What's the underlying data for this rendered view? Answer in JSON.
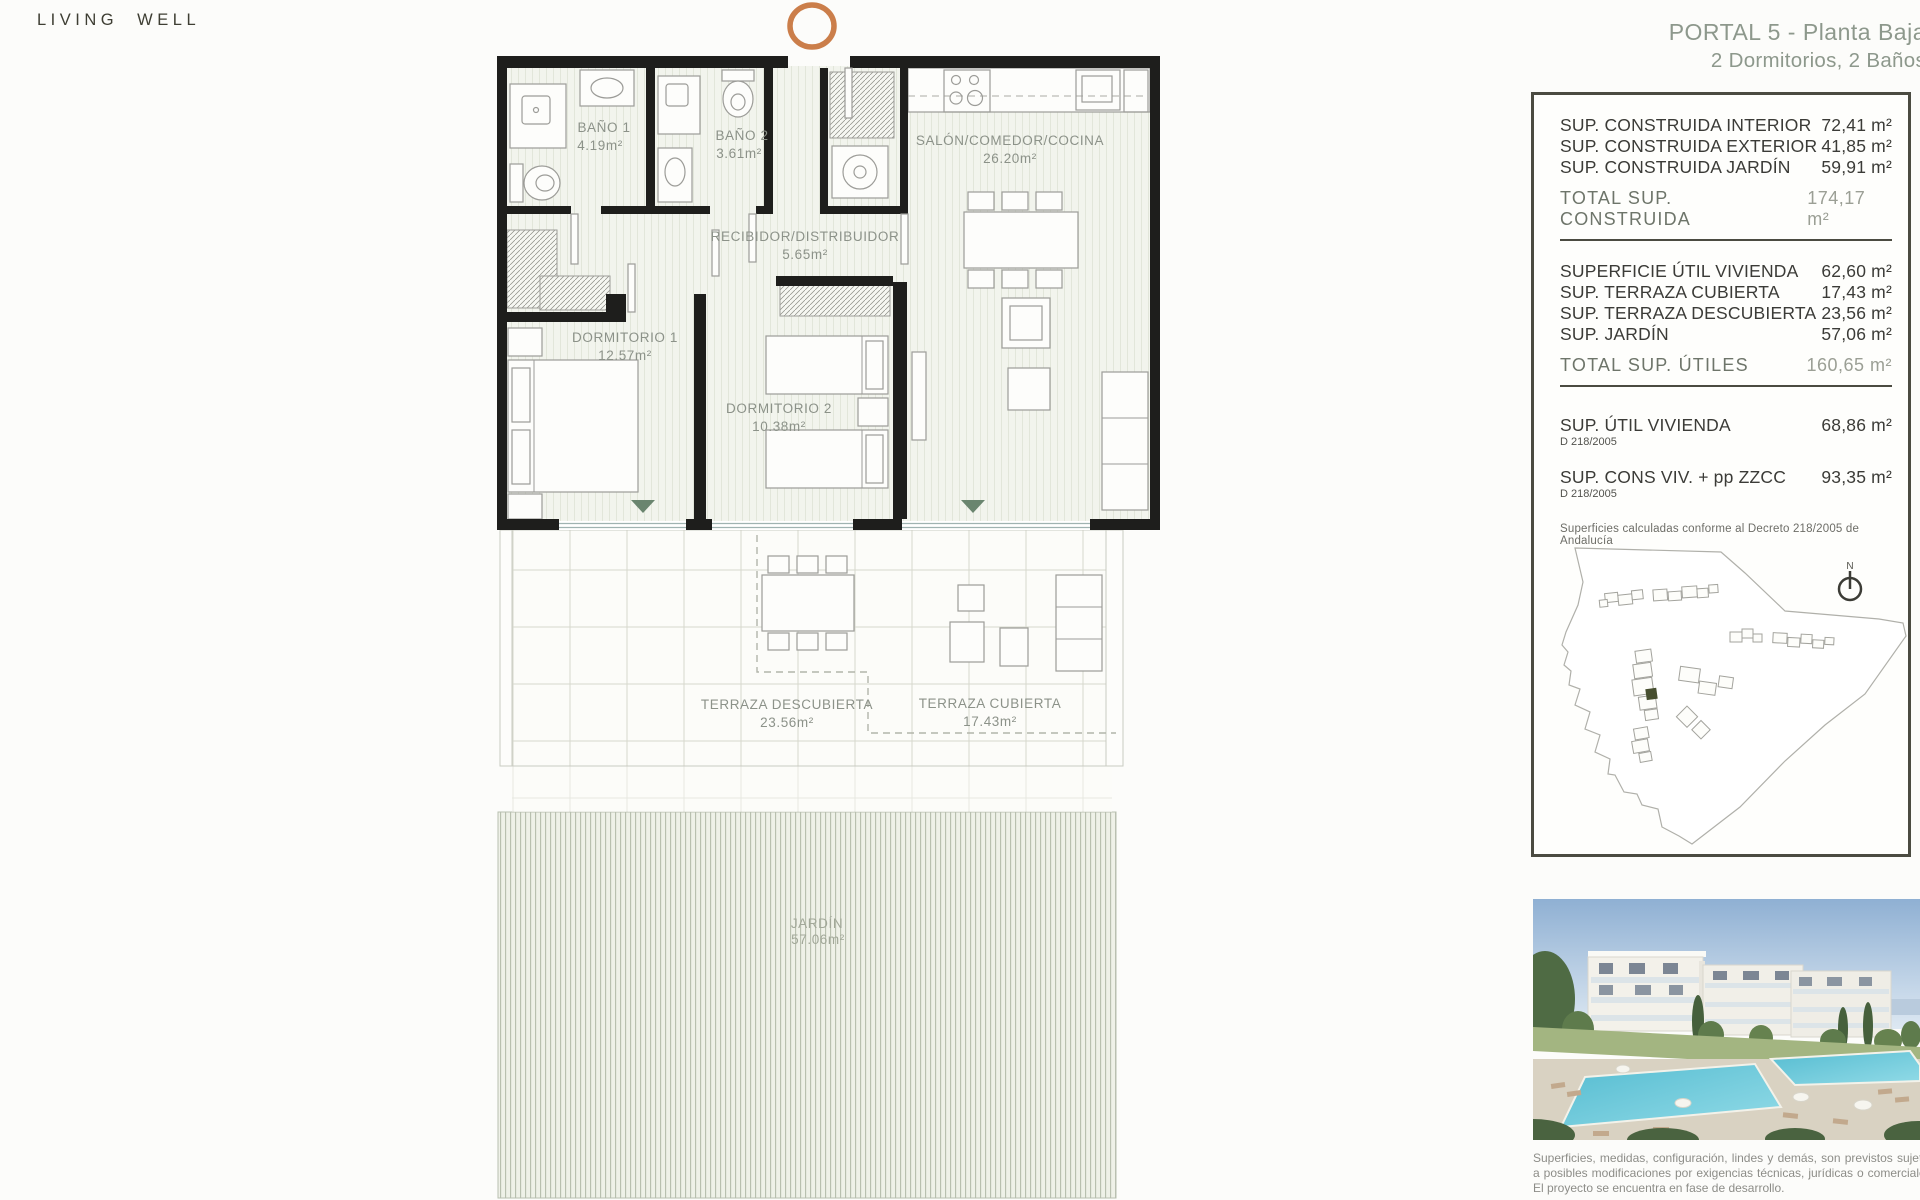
{
  "brand": {
    "logo": "LIVING WELL"
  },
  "header": {
    "title_line1": "PORTAL 5 - Planta Baja",
    "title_line2": "2 Dormitorios, 2 Baños"
  },
  "floorplan": {
    "rooms": [
      {
        "name": "BAÑO 1",
        "area": "4.19m²"
      },
      {
        "name": "BAÑO 2",
        "area": "3.61m²"
      },
      {
        "name": "SALÓN/COMEDOR/COCINA",
        "area": "26.20m²"
      },
      {
        "name": "RECIBIDOR/DISTRIBUIDOR",
        "area": "5.65m²"
      },
      {
        "name": "DORMITORIO 1",
        "area": "12.57m²"
      },
      {
        "name": "DORMITORIO 2",
        "area": "10.38m²"
      },
      {
        "name": "TERRAZA DESCUBIERTA",
        "area": "23.56m²"
      },
      {
        "name": "TERRAZA CUBIERTA",
        "area": "17.43m²"
      },
      {
        "name": "JARDÍN",
        "area": "57.06m²"
      }
    ]
  },
  "panel": {
    "construida": {
      "rows": [
        {
          "label": "SUP. CONSTRUIDA INTERIOR",
          "value": "72,41 m²"
        },
        {
          "label": "SUP. CONSTRUIDA EXTERIOR",
          "value": "41,85 m²"
        },
        {
          "label": "SUP. CONSTRUIDA JARDÍN",
          "value": "59,91 m²"
        }
      ],
      "total_label": "TOTAL SUP. CONSTRUIDA",
      "total_value": "174,17 m²"
    },
    "utiles": {
      "rows": [
        {
          "label": "SUPERFICIE ÚTIL VIVIENDA",
          "value": "62,60 m²"
        },
        {
          "label": "SUP. TERRAZA CUBIERTA",
          "value": "17,43 m²"
        },
        {
          "label": "SUP. TERRAZA DESCUBIERTA",
          "value": "23,56 m²"
        },
        {
          "label": "SUP. JARDÍN",
          "value": "57,06 m²"
        }
      ],
      "total_label": "TOTAL SUP. ÚTILES",
      "total_value": "160,65 m²"
    },
    "decreto": {
      "rows": [
        {
          "label": "SUP. ÚTIL VIVIENDA",
          "sub": "D 218/2005",
          "value": "68,86 m²"
        },
        {
          "label": "SUP. CONS VIV. + pp ZZCC",
          "sub": "D 218/2005",
          "value": "93,35 m²"
        }
      ],
      "note": "Superficies calculadas conforme al Decreto 218/2005 de Andalucía"
    },
    "map": {
      "north": "N"
    }
  },
  "footer": {
    "disclaimer": "Superficies, medidas, configuración, lindes y demás, son previstos sujetos a posibles modificaciones por exigencias técnicas, jurídicas o comerciales. El proyecto se encuentra en fase de desarrollo."
  },
  "colors": {
    "accent_orange": "#cb7e4a",
    "wall_black": "#1e1e1c",
    "title_green": "#8d988c",
    "highlight_building": "#474f30",
    "door_triangle": "#6a856f"
  }
}
